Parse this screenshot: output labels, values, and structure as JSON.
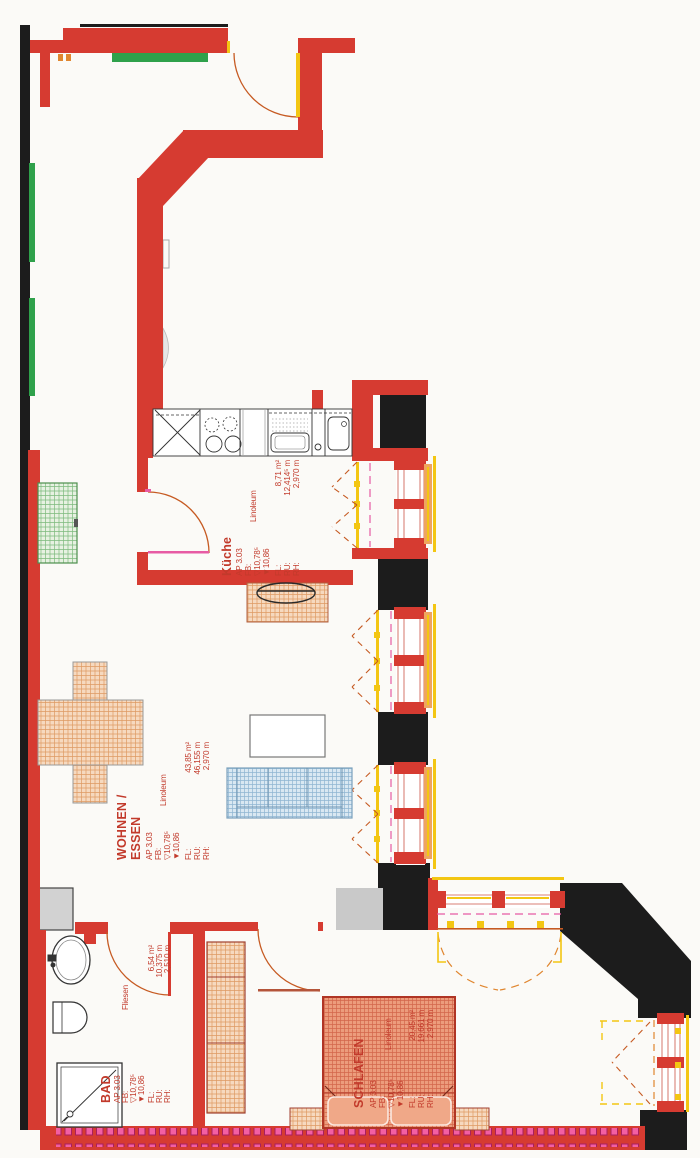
{
  "plan": {
    "rooms": {
      "kueche": {
        "name": "Küche",
        "ap": "AP 3.03",
        "fb_label": "FB:",
        "fb_upper": "▽10,78⁵",
        "fb_lower": "▼10,86",
        "material": "Linoleum",
        "fl_label": "FL:",
        "fl_value": "8,71 m²",
        "ru_label": "RU:",
        "ru_value": "12,414⁵ m",
        "rh_label": "RH:",
        "rh_value": "2,970 m"
      },
      "wohnen_essen": {
        "name_line1": "WOHNEN /",
        "name_line2": "ESSEN",
        "ap": "AP 3.03",
        "fb_label": "FB:",
        "fb_upper": "▽10,78⁵",
        "fb_lower": "▼10,86",
        "material": "Linoleum",
        "fl_label": "FL:",
        "fl_value": "43,85 m²",
        "ru_label": "RU:",
        "ru_value": "46,155 m",
        "rh_label": "RH:",
        "rh_value": "2,970 m"
      },
      "bad": {
        "name": "BAD",
        "ap": "AP 3.03",
        "fb_label": "FB:",
        "fb_upper": "▽10,78⁵",
        "fb_lower": "▼10,86",
        "material": "Fliesen",
        "fl_label": "FL:",
        "fl_value": "6,54 m²",
        "ru_label": "RU:",
        "ru_value": "10,375 m",
        "rh_label": "RH:",
        "rh_value": "2,510 m"
      },
      "schlafen": {
        "name": "SCHLAFEN",
        "ap": "AP 3.03",
        "fb_label": "FB:",
        "fb_upper": "▽10,78⁵",
        "fb_lower": "▼10,86",
        "material": "Linoleum",
        "fl_label": "FL:",
        "fl_value": "20,45 m²",
        "ru_label": "RU:",
        "ru_value": "19,661 m",
        "rh_label": "RH:",
        "rh_value": "2,970 m"
      }
    },
    "colors": {
      "wall_red": "#d63b31",
      "wall_black": "#1c1c1c",
      "wall_gray": "#cccccc",
      "marking_green": "#2fa14b",
      "window_yellow": "#f3c613",
      "door_magenta": "#e75ba4",
      "swing_orange": "#e0862f",
      "label_red": "#c23a2b"
    }
  }
}
